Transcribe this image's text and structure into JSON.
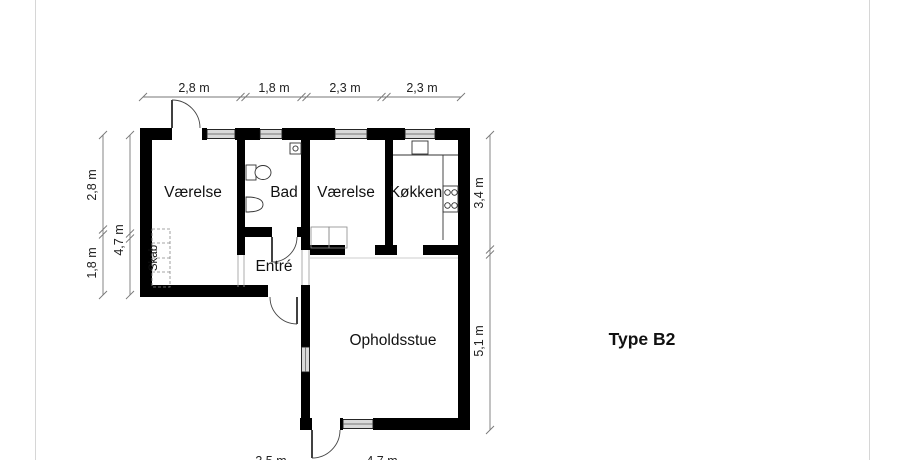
{
  "title": "Type B2",
  "rooms": {
    "vaerelse1": "Værelse",
    "bad": "Bad",
    "vaerelse2": "Værelse",
    "koekken": "Køkken",
    "entre": "Entré",
    "opholdsstue": "Opholdsstue",
    "skab": "Skab"
  },
  "dimensions": {
    "top": [
      "2,8 m",
      "1,8 m",
      "2,3 m",
      "2,3 m"
    ],
    "left_outer": [
      "2,8 m",
      "1,8 m"
    ],
    "left_inner": "4,7 m",
    "right": [
      "3,4 m",
      "5,1 m"
    ],
    "bottom": [
      "3,5 m",
      "4,7 m"
    ]
  },
  "colors": {
    "wall": "#000000",
    "window": "#d9d9d9",
    "dimension_line": "#777777",
    "background": "#ffffff"
  }
}
